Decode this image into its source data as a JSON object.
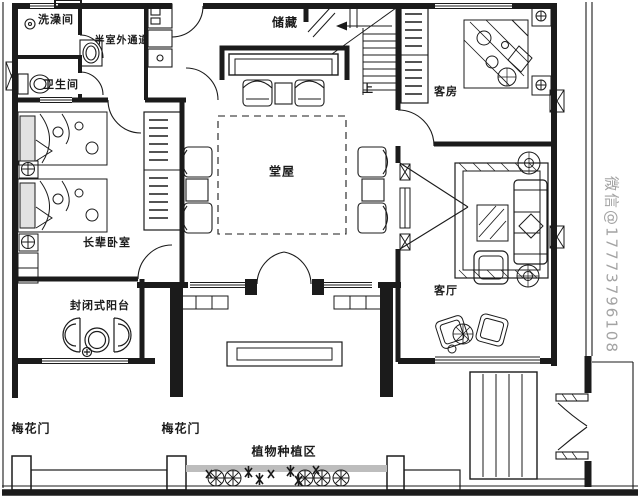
{
  "colors": {
    "ink": "#1b1b1b",
    "planting_bed_gray": "#bdbdbd",
    "watermark_gray": "#a3a3a3",
    "background": "#ffffff"
  },
  "rooms": [
    {
      "id": "shower",
      "label": "洗澡间"
    },
    {
      "id": "passage",
      "label": "半室外通道"
    },
    {
      "id": "toilet",
      "label": "卫生间"
    },
    {
      "id": "storage",
      "label": "储藏"
    },
    {
      "id": "guest-room",
      "label": "客房"
    },
    {
      "id": "hall",
      "label": "堂屋"
    },
    {
      "id": "elders-bedroom",
      "label": "长辈卧室"
    },
    {
      "id": "balcony",
      "label": "封闭式阳台"
    },
    {
      "id": "living-room",
      "label": "客厅"
    },
    {
      "id": "planting-area",
      "label": "植物种植区"
    }
  ],
  "gates": [
    {
      "label": "梅花门"
    },
    {
      "label": "梅花门"
    }
  ],
  "stairs": {
    "direction_label": "上"
  },
  "watermark": {
    "text": "微信@17773796108"
  }
}
